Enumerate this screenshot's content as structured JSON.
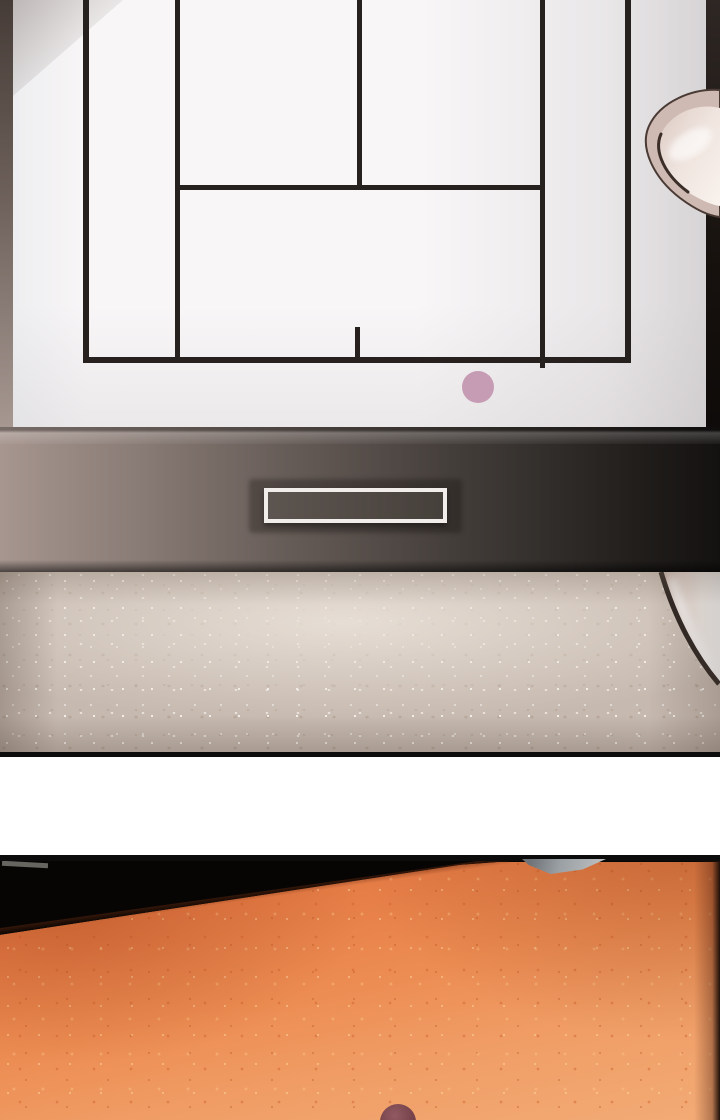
{
  "meta": {
    "type": "webtoon-comic-strip",
    "panel_count": 2,
    "text_content": "none"
  },
  "palette": {
    "screen_white": "#f8f6f7",
    "screen_edge": "#ececee",
    "line_black": "#26211f",
    "bezel_left_top": "#463c37",
    "bezel_left_bottom": "#a89a93",
    "bezel_right": "#17110e",
    "frame_light": "#a79690",
    "frame_dark": "#141211",
    "vent_border": "#f0edeb",
    "vent_fill": "#504843",
    "carpet_base": "#c6b9af",
    "carpet_sparkle": "#f2ebe3",
    "panel_border": "#0c0c0c",
    "gutter_white": "#ffffff",
    "room_black": "#070504",
    "floor_dark": "#c96636",
    "floor_base": "#ec8c52",
    "floor_light": "#f3ab76",
    "wedge_light": "#b9bdbf",
    "wedge_dark": "#6f7377",
    "pink_dot": "#c69cb4",
    "plum_dot": "#6e3c45",
    "plum_hl": "#925a62",
    "skin": "#cfb9b3",
    "nail": "#f0e5df",
    "outline_dark": "#3b2d28",
    "orb_edge": "#2e2521"
  },
  "panel1": {
    "description": "Close-up of a TV screen showing a black-line court diagram on white; a fingertip at the right edge; dark gradient TV frame with a white-outlined vent slot; sparkly beige carpet below with a pale round object at bottom right.",
    "screen": {
      "court_lines": [
        {
          "x": 83,
          "y": 0,
          "w": 6,
          "h": 363
        },
        {
          "x": 175,
          "y": 0,
          "w": 5,
          "h": 363
        },
        {
          "x": 357,
          "y": 0,
          "w": 5,
          "h": 190
        },
        {
          "x": 540,
          "y": 0,
          "w": 5,
          "h": 368
        },
        {
          "x": 625,
          "y": 0,
          "w": 6,
          "h": 363
        },
        {
          "x": 175,
          "y": 185,
          "w": 370,
          "h": 5
        },
        {
          "x": 83,
          "y": 357,
          "w": 548,
          "h": 6
        },
        {
          "x": 355,
          "y": 327,
          "w": 5,
          "h": 33
        }
      ],
      "ball_dot": {
        "x": 478,
        "y": 387,
        "r": 16
      }
    }
  },
  "panel2": {
    "description": "Dark room; bright orange textured floor rising diagonally to the right; small metal wedge at the top edge; plum-colored round object partially visible at the bottom.",
    "plum_dot": {
      "x": 398,
      "y": 267,
      "r": 18
    }
  }
}
